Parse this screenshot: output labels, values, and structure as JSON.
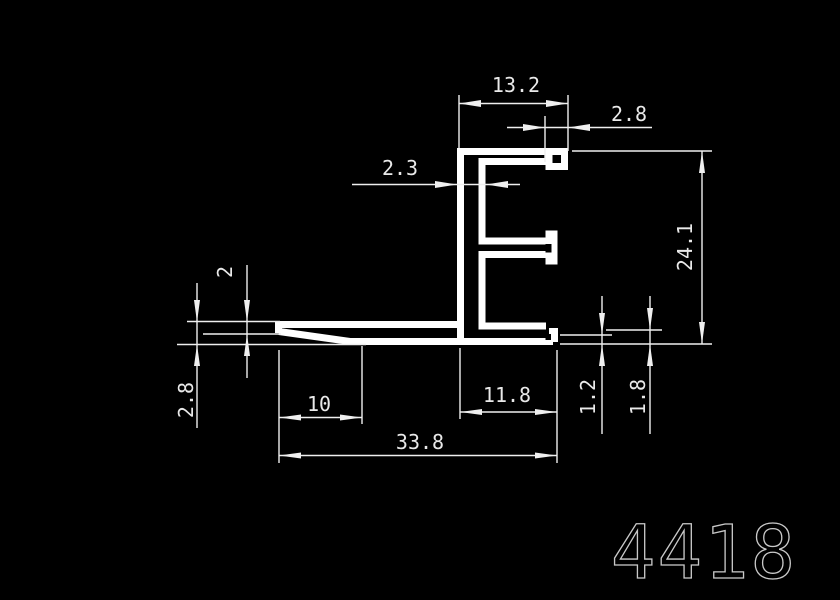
{
  "drawing": {
    "part_number": "4418",
    "colors": {
      "background": "#000000",
      "profile_stroke": "#ffffff",
      "thin_line": "#efefef",
      "label_text": "#e9e9e9",
      "part_number_text": "#c9c9c9"
    },
    "profile_paths": [
      {
        "d": "M 460.5 148 V 341",
        "w": 7
      },
      {
        "d": "M 457 151.5 H 568",
        "w": 7
      },
      {
        "d": "M 564.5 148 L 564.5 166.5 L 549 166.5 L 549 155",
        "w": 7
      },
      {
        "d": "M 546 161.5 L 482 161.5 L 482 241 L 546 241",
        "w": 7
      },
      {
        "d": "M 551.5 230.5 V 264.5",
        "w": 12
      },
      {
        "d": "M 546 254.5 L 482 254.5 L 482 326 L 546 326",
        "w": 7
      },
      {
        "d": "M 278.5 324.5 H 458",
        "w": 7
      },
      {
        "d": "M 278.5 321.5 V 333",
        "w": 7
      },
      {
        "d": "M 279 331.5 L 350 341.5 L 553 341.5",
        "w": 7
      },
      {
        "d": "M 553.5 342 V 328",
        "w": 9
      }
    ],
    "notches": [
      {
        "x": 545.5,
        "y": 244,
        "w": 6,
        "h": 8.5
      },
      {
        "x": 545.5,
        "y": 334,
        "w": 5.5,
        "h": 6
      }
    ],
    "thin_lines": [
      [
        459,
        95,
        459,
        148
      ],
      [
        568,
        95,
        568,
        151
      ],
      [
        459,
        103.5,
        568,
        103.5
      ],
      [
        545,
        116,
        545,
        162
      ],
      [
        507,
        127.5,
        652,
        127.5
      ],
      [
        352,
        184.5,
        520,
        184.5
      ],
      [
        572,
        151,
        712,
        151
      ],
      [
        560,
        344,
        712,
        344
      ],
      [
        702,
        151,
        702,
        344
      ],
      [
        560,
        335,
        612,
        335
      ],
      [
        602,
        296,
        602,
        434
      ],
      [
        606,
        330,
        662,
        330
      ],
      [
        650,
        296,
        650,
        434
      ],
      [
        362,
        346,
        362,
        424
      ],
      [
        279,
        417.5,
        362,
        417.5
      ],
      [
        460,
        348,
        460,
        419
      ],
      [
        460,
        412,
        557,
        412
      ],
      [
        279,
        350,
        279,
        463
      ],
      [
        557,
        350,
        557,
        463
      ],
      [
        279,
        455.5,
        557,
        455.5
      ],
      [
        247,
        265,
        247,
        378
      ],
      [
        203,
        334,
        281,
        334
      ],
      [
        197,
        283,
        197,
        428
      ],
      [
        187,
        321.5,
        280,
        321.5
      ],
      [
        177,
        344.5,
        366,
        344.5
      ]
    ],
    "arrows": [
      "459,103.5 481,100 481,107",
      "568,103.5 546,100 546,107",
      "545,127.5 523,124 523,131",
      "568,127.5 590,124 590,131",
      "457,184.5 435,181 435,188",
      "486,184.5 508,181 508,188",
      "702,151 699,173 705,173",
      "702,344 699,322 705,322",
      "602,335 599,313 605,313",
      "602,344 599,366 605,366",
      "650,330 647,308 653,308",
      "650,344 647,366 653,366",
      "279,417.5 301,414.5 301,420.5",
      "362,417.5 340,414.5 340,420.5",
      "460,412 482,409 482,415",
      "557,412 535,409 535,415",
      "279,455.5 301,452.5 301,458.5",
      "557,455.5 535,452.5 535,458.5",
      "247,322 244,300 250,300",
      "247,334 244,356 250,356",
      "197,322 194,300 200,300",
      "197,344.5 194,366 200,366"
    ],
    "labels": [
      {
        "text": "13.2",
        "x": 516,
        "y": 92,
        "rot": 0
      },
      {
        "text": "2.8",
        "x": 629,
        "y": 121,
        "rot": 0
      },
      {
        "text": "2.3",
        "x": 400,
        "y": 175,
        "rot": 0
      },
      {
        "text": "24.1",
        "x": 692,
        "y": 247,
        "rot": -90
      },
      {
        "text": "1.2",
        "x": 595,
        "y": 397,
        "rot": -90
      },
      {
        "text": "1.8",
        "x": 645,
        "y": 397,
        "rot": -90
      },
      {
        "text": "10",
        "x": 319,
        "y": 411,
        "rot": 0
      },
      {
        "text": "11.8",
        "x": 507,
        "y": 402,
        "rot": 0
      },
      {
        "text": "33.8",
        "x": 420,
        "y": 449,
        "rot": 0
      },
      {
        "text": "2",
        "x": 232,
        "y": 272,
        "rot": -90
      },
      {
        "text": "2.8",
        "x": 193,
        "y": 400,
        "rot": -90
      }
    ]
  }
}
